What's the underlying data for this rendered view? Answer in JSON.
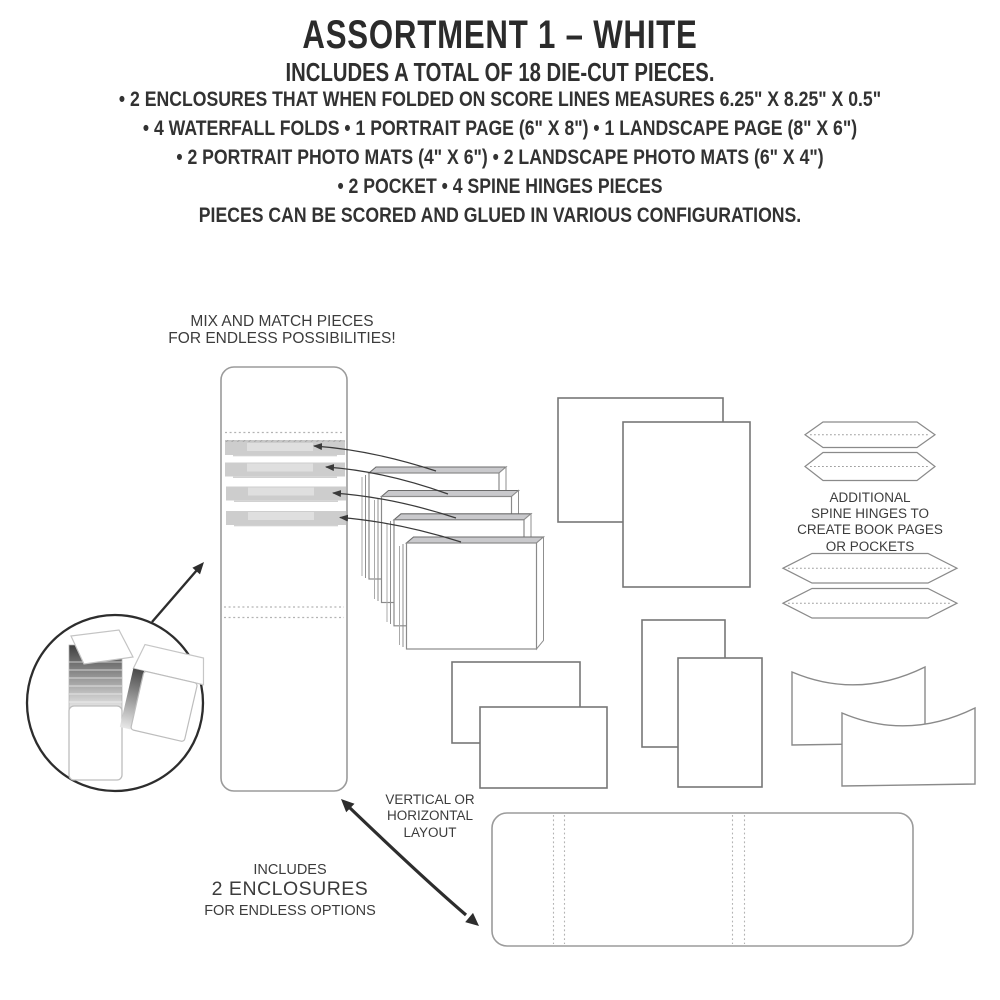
{
  "header": {
    "title": "ASSORTMENT 1 – WHITE",
    "subtitle": "INCLUDES A TOTAL OF 18 DIE-CUT PIECES.",
    "lines": [
      "• 2 ENCLOSURES THAT WHEN FOLDED ON SCORE LINES MEASURES 6.25\" X 8.25\" X 0.5\"",
      "• 4 WATERFALL FOLDS • 1 PORTRAIT PAGE (6\" X 8\") • 1 LANDSCAPE PAGE (8\" X 6\")",
      "• 2 PORTRAIT PHOTO MATS (4\" X 6\") • 2 LANDSCAPE PHOTO MATS (6\" X 4\")",
      "• 2 POCKET • 4 SPINE HINGES PIECES",
      "PIECES CAN BE SCORED AND GLUED IN VARIOUS CONFIGURATIONS."
    ]
  },
  "labels": {
    "mix_match": {
      "line1": "MIX AND MATCH PIECES",
      "line2": "FOR ENDLESS POSSIBILITIES!"
    },
    "spine_hinges": {
      "line1": "ADDITIONAL",
      "line2": "SPINE HINGES TO",
      "line3": "CREATE BOOK PAGES",
      "line4": "OR POCKETS"
    },
    "layout": {
      "line1": "VERTICAL OR",
      "line2": "HORIZONTAL",
      "line3": "LAYOUT"
    },
    "enclosures": {
      "line1": "INCLUDES",
      "line2": "2 ENCLOSURES",
      "line3": "FOR ENDLESS OPTIONS"
    }
  },
  "diagram": {
    "pieces": [
      "vertical-enclosure",
      "waterfall-folds-stack",
      "portrait-page",
      "landscape-page",
      "spine-hinges",
      "portrait-photo-mats",
      "landscape-photo-mats",
      "pocket-pieces",
      "horizontal-enclosure",
      "enclosure-detail-inset"
    ],
    "icons": [
      "curved-pointer-arrows",
      "double-headed-arrow",
      "inset-pointer-arrow"
    ]
  },
  "colors": {
    "text_dark": "#2b2b2b",
    "label_text": "#3c3c3c",
    "line_art_stroke": "#8a8a8a",
    "enclosure_stroke": "#9b9b9b",
    "strip_fill": "#cdcdcd",
    "card_top_fill": "#c9c9cc",
    "arrow_dark": "#2d2d2d",
    "background": "#ffffff"
  }
}
